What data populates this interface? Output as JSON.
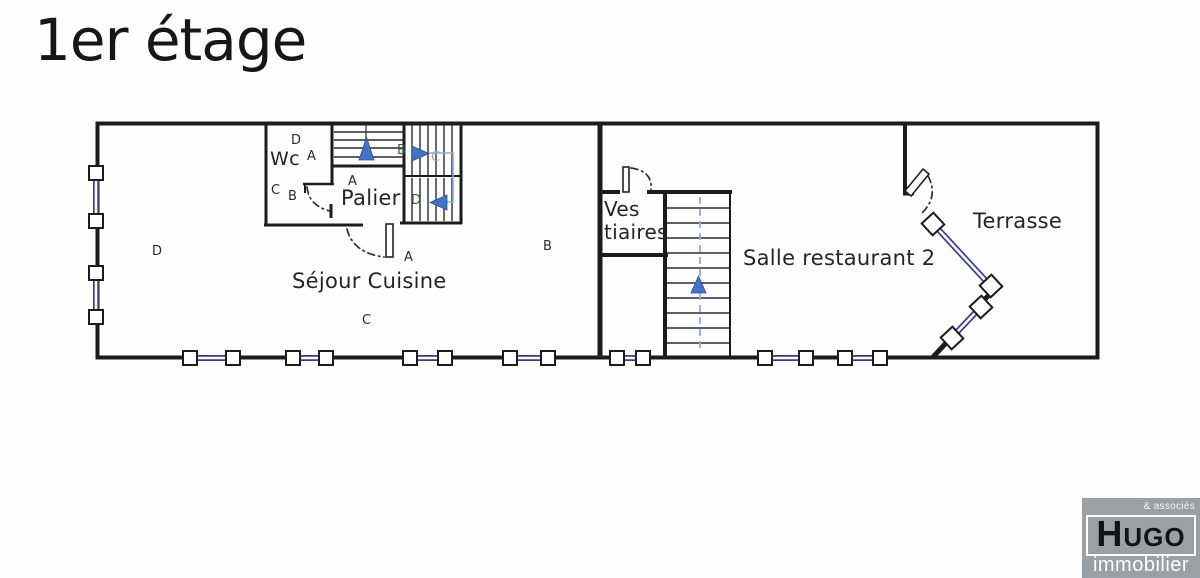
{
  "title": "1er étage",
  "rooms": {
    "wc": "Wc",
    "palier": "Palier",
    "sejour_cuisine": "Séjour Cuisine",
    "vestiaires_line1": "Ves",
    "vestiaires_line2": "tiaires",
    "salle_restaurant": "Salle restaurant 2",
    "terrasse": "Terrasse"
  },
  "zone_markers": [
    {
      "label": "D",
      "x": 152,
      "y": 245,
      "variant": ""
    },
    {
      "label": "C",
      "x": 362,
      "y": 314,
      "variant": ""
    },
    {
      "label": "B",
      "x": 543,
      "y": 240,
      "variant": ""
    },
    {
      "label": "A",
      "x": 404,
      "y": 251,
      "variant": ""
    },
    {
      "label": "A",
      "x": 348,
      "y": 175,
      "variant": ""
    },
    {
      "label": "D",
      "x": 291,
      "y": 134,
      "variant": ""
    },
    {
      "label": "A",
      "x": 307,
      "y": 150,
      "variant": ""
    },
    {
      "label": "C",
      "x": 271,
      "y": 184,
      "variant": ""
    },
    {
      "label": "B",
      "x": 288,
      "y": 190,
      "variant": ""
    },
    {
      "label": "B",
      "x": 397,
      "y": 144,
      "variant": "green"
    },
    {
      "label": "C",
      "x": 431,
      "y": 151,
      "variant": "muted"
    },
    {
      "label": "D",
      "x": 411,
      "y": 194,
      "variant": "green"
    }
  ],
  "brand": {
    "tagline": "& associés",
    "name": "HUGO",
    "subtitle": "immobilier"
  },
  "colors": {
    "wall": "#1c1c1c",
    "window_glass_blue": "#39399a",
    "arrow_blue": "#4273c8",
    "stair_guide_blue": "#93abd6",
    "logo_gray": "#9ba0a5"
  }
}
